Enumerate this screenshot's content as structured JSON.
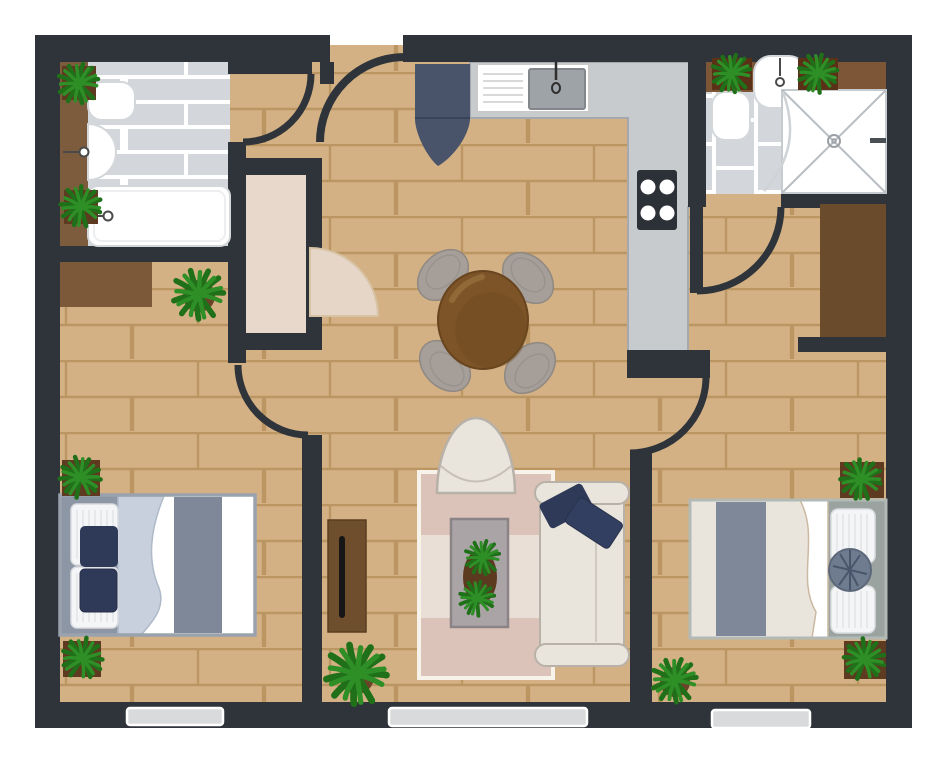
{
  "title": "two-bedroom-apartment-floor-plan",
  "palette": {
    "page-bg": "#ffffff",
    "wall": "#2f343a",
    "floor": "#d3b184",
    "mortar": "#b08a55",
    "tile": "#d3d7dc",
    "grout": "#ffffff",
    "counter": "#c7cbce",
    "counter-edge": "#a5a9ad",
    "closet-beige": "#e7d8cb",
    "door-leaf-beige": "#e6d6c8",
    "door-leaf-edge": "#d8c2a4",
    "brown-counter": "#7d5c3e",
    "brown-shelf": "#7c5636",
    "dresser": "#7c5a39",
    "wardrobe": "#6a4b2c",
    "console": "#6f4e2d",
    "table-wood": "#7c5428",
    "table-wood-edge": "#68451f",
    "chair-gray": "#a59e99",
    "chair-edge": "#8f8883",
    "fridge-navy": "#49546a",
    "pillow-navy": "#2f3a59",
    "cream": "#e9e4dc",
    "cream-edge": "#b7b1a8",
    "rug-pink": "#dcc3b9",
    "rug-cream": "#eadfd6",
    "rug-border": "#f7f2ea",
    "bed-frame": "#9aa2ae",
    "headboard": "#8d96a4",
    "band": "#7e8899",
    "blanket": "#c7d0dc",
    "base-gray": "#9aa39f",
    "round-pillow": "#6f7b8f",
    "plant": "#2f8f27",
    "plant-dark": "#1f7019",
    "pot": "#6b4328",
    "pot-square": "#5e3a20",
    "stove": "#2c3037",
    "burner": "#ffffff",
    "window": "#d9dadc",
    "white": "#ffffff",
    "fixture-edge": "#d3d7da",
    "metal": "#4a4a4a"
  },
  "rooms": [
    {
      "id": "bathroom-left",
      "name": "bathroom"
    },
    {
      "id": "closet",
      "name": "closet"
    },
    {
      "id": "entry-hall",
      "name": "entry hall"
    },
    {
      "id": "kitchen",
      "name": "kitchen"
    },
    {
      "id": "dining-area",
      "name": "dining area"
    },
    {
      "id": "living-room",
      "name": "living room"
    },
    {
      "id": "bedroom-left",
      "name": "bedroom"
    },
    {
      "id": "bathroom-right",
      "name": "bathroom"
    },
    {
      "id": "bedroom-right",
      "name": "bedroom"
    }
  ],
  "furniture": [
    {
      "room": "bathroom-left",
      "items": [
        "toilet",
        "sink",
        "bathtub",
        "counter-strip",
        "2 plants"
      ]
    },
    {
      "room": "kitchen",
      "items": [
        "l-shaped-counter",
        "dish-rack",
        "sink",
        "stove-4-burner",
        "fridge"
      ]
    },
    {
      "room": "dining-area",
      "items": [
        "round-table",
        "4 chairs"
      ]
    },
    {
      "room": "living-room",
      "items": [
        "striped-rug",
        "armchair",
        "coffee-table",
        "plant",
        "sofa",
        "2 navy pillows",
        "console-table"
      ]
    },
    {
      "room": "bedroom-left",
      "items": [
        "dresser",
        "double-bed",
        "2 pillows",
        "2 navy cushions",
        "blanket",
        "3 plants"
      ]
    },
    {
      "room": "bathroom-right",
      "items": [
        "shelf",
        "toilet",
        "sink",
        "shower",
        "2 plants"
      ]
    },
    {
      "room": "bedroom-right",
      "items": [
        "wardrobe",
        "double-bed",
        "2 pillows",
        "round-pillow",
        "3 plants"
      ]
    }
  ],
  "doors": {
    "count": 6,
    "list": [
      "entry",
      "bathroom-left",
      "closet",
      "bedroom-left",
      "bathroom-right",
      "bedroom-right"
    ]
  },
  "windows": {
    "count": 3,
    "location": "bottom wall"
  },
  "plants_total": 12
}
